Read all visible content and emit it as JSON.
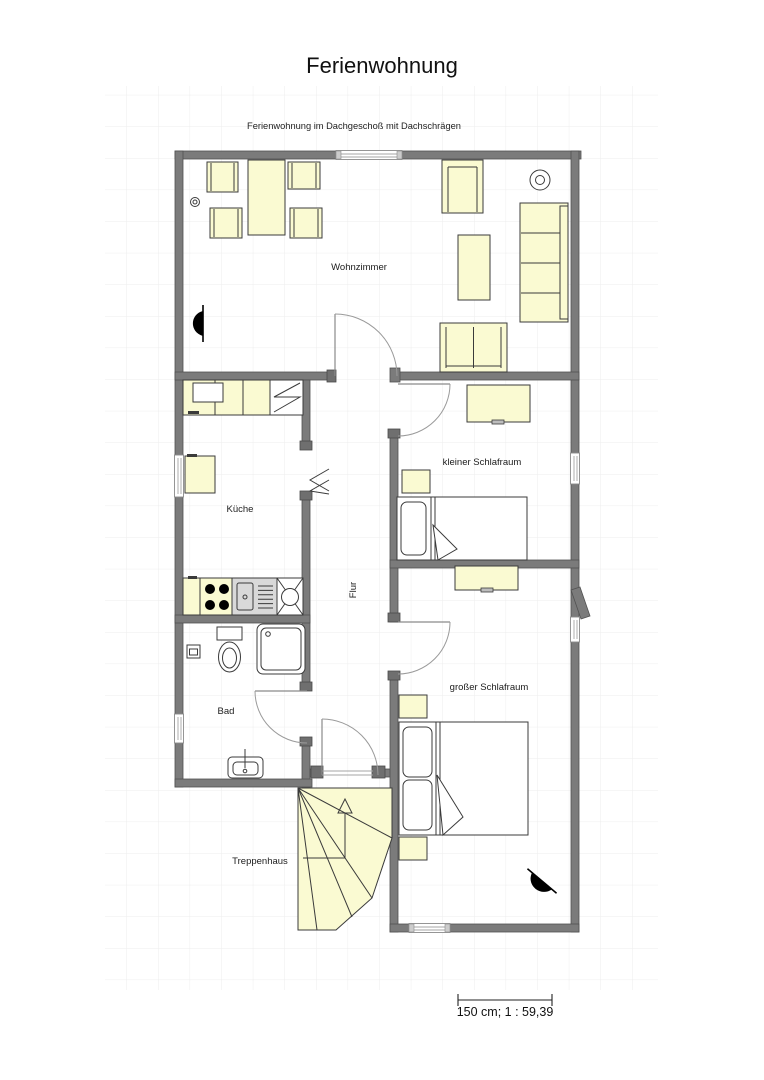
{
  "header": {
    "title": "Ferienwohnung",
    "subtitle": "Ferienwohnung im Dachgeschoß mit Dachschrägen"
  },
  "rooms": {
    "living": "Wohnzimmer",
    "kitchen": "Küche",
    "bath": "Bad",
    "hall": "Flur",
    "small_bedroom": "kleiner Schlafraum",
    "large_bedroom": "großer Schlafraum",
    "stairwell": "Treppenhaus"
  },
  "scale": {
    "label": "150 cm; 1 : 59,39"
  },
  "colors": {
    "wall": "#7b7b7b",
    "furniture_fill": "#fafad2",
    "grid": "#ededed",
    "symbol": "#000000",
    "background": "#ffffff"
  }
}
